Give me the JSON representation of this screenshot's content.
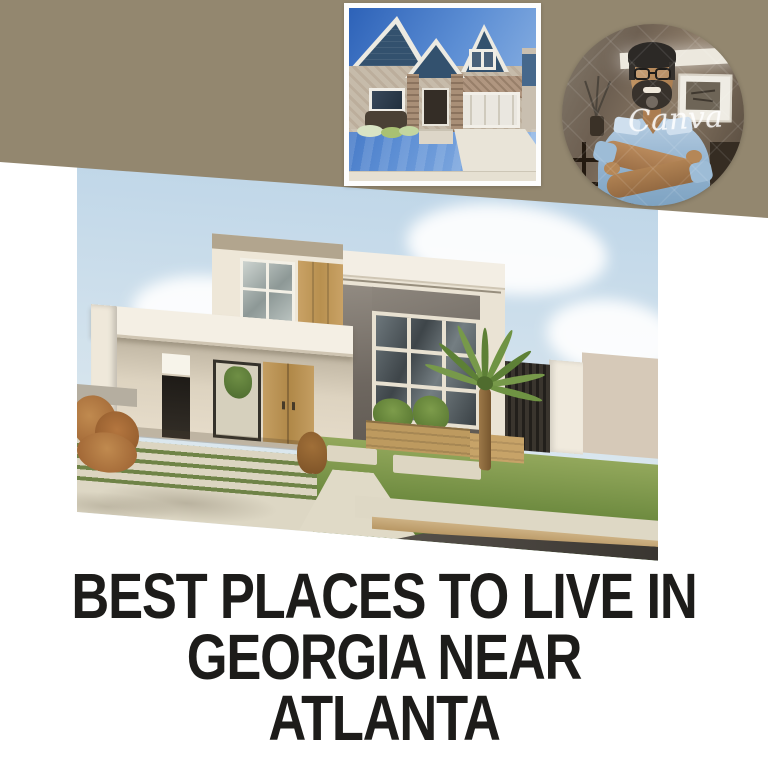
{
  "page": {
    "background": "#ffffff",
    "width": 768,
    "height": 768
  },
  "header_band": {
    "color": "#93876f"
  },
  "headline": {
    "line1": "BEST PLACES TO LIVE IN",
    "line2": "GEORGIA NEAR ATLANTA",
    "color": "#1d1c1a"
  },
  "watermark": {
    "text": "Canva"
  },
  "images": {
    "top_photo_label": "craftsman house with blue gables",
    "main_photo_label": "modern two-story house with palm tree",
    "avatar_label": "smiling man with glasses and crossed arms"
  }
}
